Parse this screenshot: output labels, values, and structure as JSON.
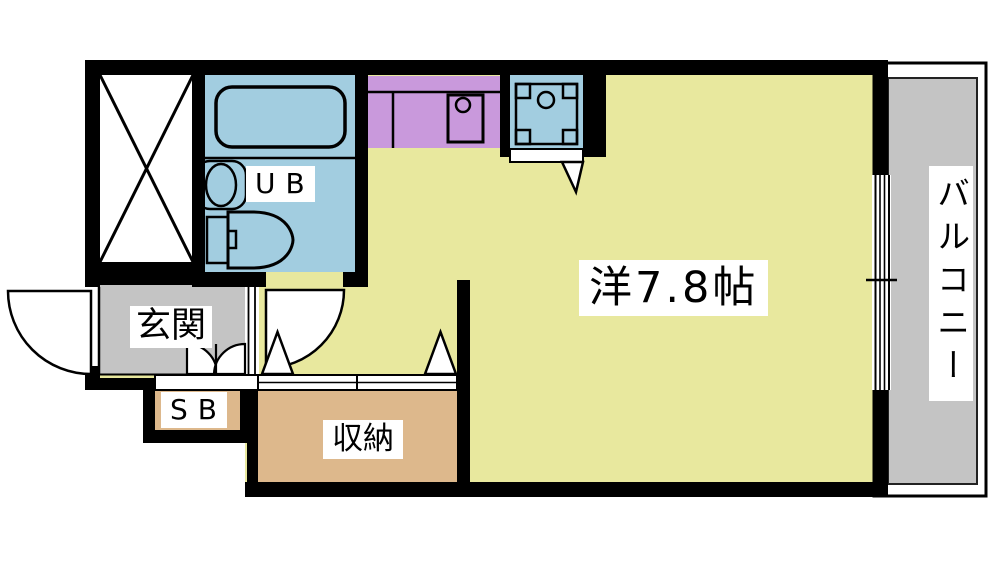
{
  "floor_plan": {
    "labels": {
      "entrance": "玄関",
      "shoe_box": "SB",
      "unit_bath": "UB",
      "main_room": "洋7.8帖",
      "storage": "収納",
      "balcony": "バルコニー"
    },
    "colors": {
      "room_floor": "#e8e89e",
      "kitchen_counter": "#c999dc",
      "water_blue": "#a2cde0",
      "gray_floor": "#c4c4c4",
      "storage_tan": "#ddb88c",
      "wall": "#000000",
      "label_bg": "#ffffff"
    },
    "icons": {
      "bathtub": "bathtub-icon",
      "toilet": "toilet-icon",
      "washbasin": "washbasin-icon",
      "kitchen_sink": "kitchen-sink-icon",
      "washing_machine_pan": "washing-machine-pan-icon",
      "entrance_door": "entrance-door-swing-icon",
      "bath_door": "bath-door-swing-icon",
      "double_door": "double-door-icon",
      "closet_doors": "closet-door-triangle-icon",
      "window": "window-icon",
      "cross_box": "cross-box-icon"
    }
  }
}
